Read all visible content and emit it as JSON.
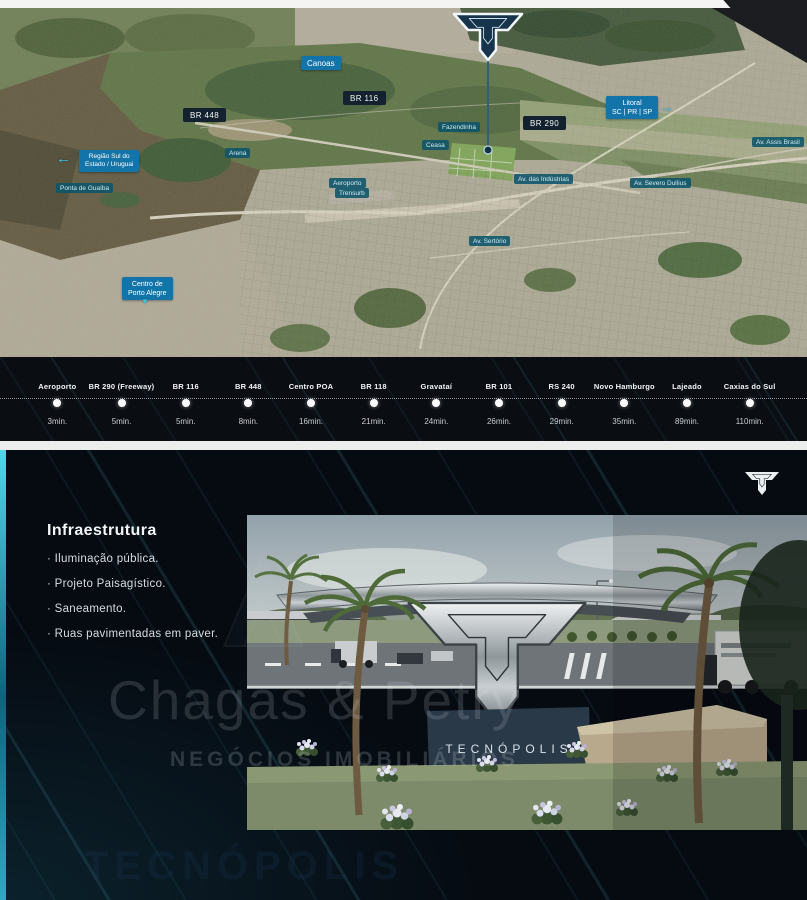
{
  "map": {
    "labels": {
      "canoas": "Canoas",
      "br116": "BR 116",
      "br448": "BR 448",
      "br290": "BR 290",
      "litoral_line1": "Litoral",
      "litoral_line2": "SC | PR | SP",
      "regiao_line1": "Região Sul do",
      "regiao_line2": "Estado / Uruguai",
      "ponta_guaiba": "Ponta de Guaíba",
      "fazendinha": "Fazendinha",
      "ceasa": "Ceasa",
      "arena": "Arena",
      "aeroporto": "Aeroporto",
      "trensurb": "Trensurb",
      "av_assis_brasil": "Av. Assis Brasil",
      "av_industrias": "Av. das Indústrias",
      "av_severo_dullius": "Av. Severo Dullius",
      "av_sertorio": "Av. Sertório",
      "centro_line1": "Centro de",
      "centro_line2": "Porto Alegre"
    },
    "arrow_left": "←",
    "arrow_right": "→",
    "arrow_down": "▼"
  },
  "timeline": {
    "stops": [
      {
        "label": "Aeroporto",
        "time": "3min."
      },
      {
        "label": "BR 290 (Freeway)",
        "time": "5min."
      },
      {
        "label": "BR 116",
        "time": "5min."
      },
      {
        "label": "BR 448",
        "time": "8min."
      },
      {
        "label": "Centro POA",
        "time": "16min."
      },
      {
        "label": "BR 118",
        "time": "21min."
      },
      {
        "label": "Gravataí",
        "time": "24min."
      },
      {
        "label": "BR 101",
        "time": "26min."
      },
      {
        "label": "RS 240",
        "time": "29min."
      },
      {
        "label": "Novo Hamburgo",
        "time": "35min."
      },
      {
        "label": "Lajeado",
        "time": "89min."
      },
      {
        "label": "Caxias do Sul",
        "time": "110min."
      }
    ]
  },
  "infra": {
    "title": "Infraestrutura",
    "items": [
      "· Iluminação pública.",
      "· Projeto Paisagístico.",
      "· Saneamento.",
      "· Ruas pavimentadas em paver."
    ]
  },
  "watermark": {
    "line1": "Chagas & Petry",
    "line2": "NEGÓCIOS IMOBILIÁRIOS"
  },
  "render": {
    "monument_text": "TECNÓPOLIS"
  },
  "footer": {
    "ghost": "TECNÓPOLIS"
  },
  "colors": {
    "label_blue": "#1274a8",
    "label_navy": "#13222e",
    "label_teal": "#0c546a",
    "accent_cyan": "#3fc0e0",
    "section_bg": "#060b12",
    "logo_navy": "#16354d"
  }
}
